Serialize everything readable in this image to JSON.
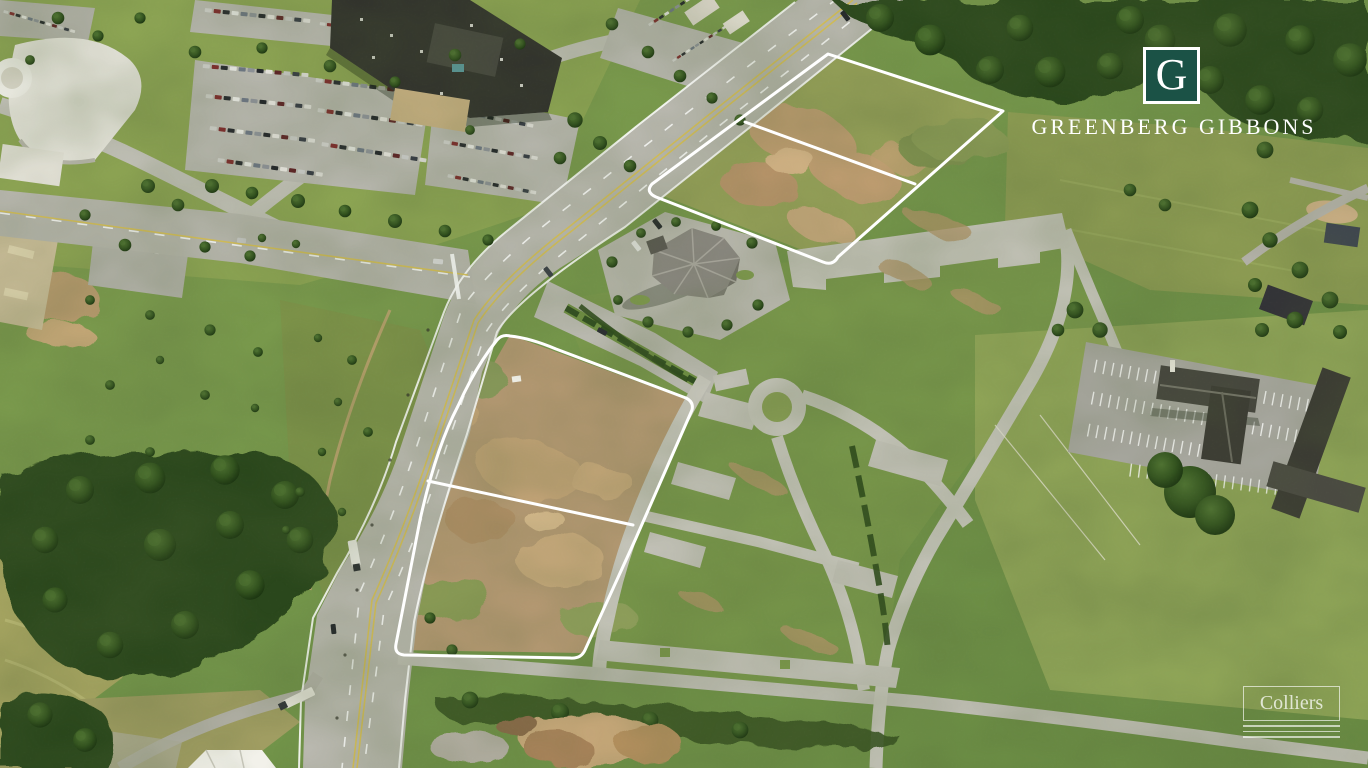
{
  "branding": {
    "greenberg_gibbons": {
      "monogram": "G",
      "wordmark": "GREENBERG GIBBONS",
      "logo_green": "#1b5246",
      "text_color": "#ffffff"
    },
    "colliers": {
      "wordmark": "Colliers",
      "text_color": "#ffffff"
    }
  },
  "overlay": {
    "parcel_outline_color": "#ffffff",
    "outlined_parcels": "2"
  }
}
